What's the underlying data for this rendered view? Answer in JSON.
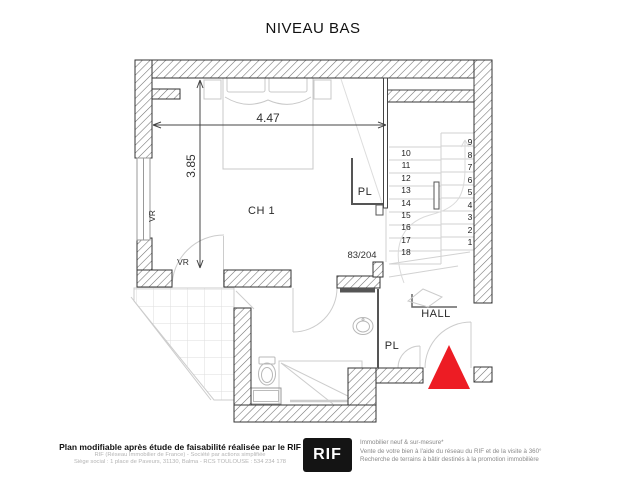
{
  "title": "NIVEAU BAS",
  "colors": {
    "entrance_marker": "#ed1c24",
    "logo_bg": "#141414",
    "wall_hatch": "#6f6f6f",
    "wall_stroke": "#333333",
    "furniture": "#c8c8c8"
  },
  "plan": {
    "rooms": {
      "bedroom": "CH 1",
      "hall": "HALL",
      "closet_upper": "PL",
      "closet_lower": "PL",
      "shutter_left": "VR",
      "shutter_mid": "VR",
      "door_size": "83/204"
    },
    "dimensions": {
      "width_label": "4.47",
      "height_label": "3.85"
    },
    "stairs": {
      "left_flight": [
        "10",
        "11",
        "12",
        "13",
        "14",
        "15",
        "16",
        "17",
        "18"
      ],
      "right_flight": [
        "9",
        "8",
        "7",
        "6",
        "5",
        "4",
        "3",
        "2",
        "1"
      ]
    }
  },
  "footer": {
    "left": {
      "bold": "Plan modifiable après étude de faisabilité réalisée par le RIF",
      "line1": "RIF (Réseau Immobilier de France) - Société par actions simplifiée",
      "line2": "Siège social : 1 place de Paveurs, 31130, Balma - RCS TOULOUSE : 534 234 178"
    },
    "logo_text": "RIF",
    "right": {
      "line1": "Immobilier neuf & sur-mesure*",
      "line2": "Vente de votre bien à l'aide du réseau du RIF et de la visite à 360°",
      "line3": "Recherche de terrains à bâtir destinés à la promotion immobilière"
    }
  }
}
